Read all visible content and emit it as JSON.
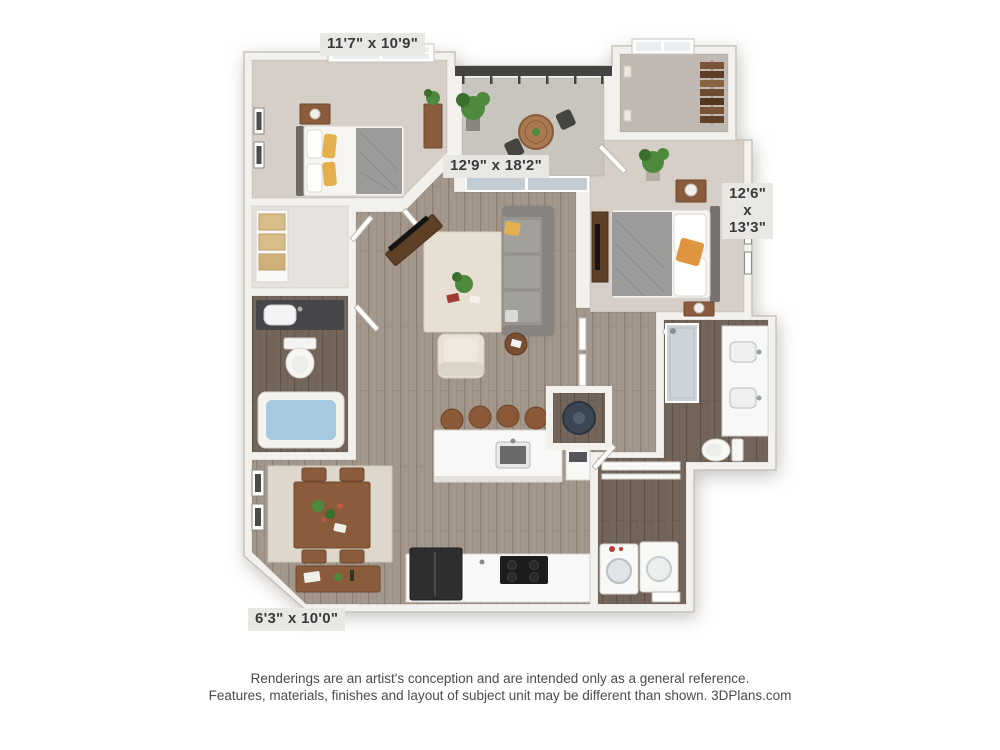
{
  "palette": {
    "page_bg": "#ffffff",
    "wall_fill": "#f3f1ee",
    "wall_edge": "#c7c3bd",
    "carpet": "#d5cfc8",
    "carpet_dark": "#bfb9b1",
    "closet_floor": "#e6e3de",
    "concrete": "#c8c5bf",
    "wood": "#a3968a",
    "wood_line": "#8d8073",
    "wood_dark": "#74655a",
    "wood_dark_line": "#5f5146",
    "rug": "#e6dfd2",
    "dining_rug": "#ddd8cb",
    "sofa": "#9a9792",
    "sofa_dark": "#87847f",
    "cream": "#e8e2d6",
    "wood_furn": "#8a5c3c",
    "wood_furn_dark": "#6e472d",
    "bed_white": "#f6f5f2",
    "blanket_gray": "#9b9b99",
    "pillow_yellow": "#e4b04e",
    "pillow_orange": "#df9440",
    "plant": "#4d8a3d",
    "plant_dark": "#3a6f2e",
    "water": "#a6c9e0",
    "appliance_dark": "#2e2e30",
    "railing": "#434341",
    "glass": "#c3ccd2",
    "label_bg": "#e9e7e3",
    "label_text": "#3a3a3a",
    "footer_text": "#4b4b4b"
  },
  "floorplan": {
    "dimension_labels": {
      "bedroom1": "11'7\" x 10'9\"",
      "living": "12'9\" x 18'2\"",
      "bedroom2": {
        "line1": "12'6\"",
        "line2": "x",
        "line3": "13'3\""
      },
      "dining": "6'3\" x 10'0\""
    }
  },
  "footer": {
    "line1": "Renderings are an artist's conception and are intended only as a general reference.",
    "line2": "Features, materials, finishes and layout of subject unit may be different than shown. 3DPlans.com"
  }
}
